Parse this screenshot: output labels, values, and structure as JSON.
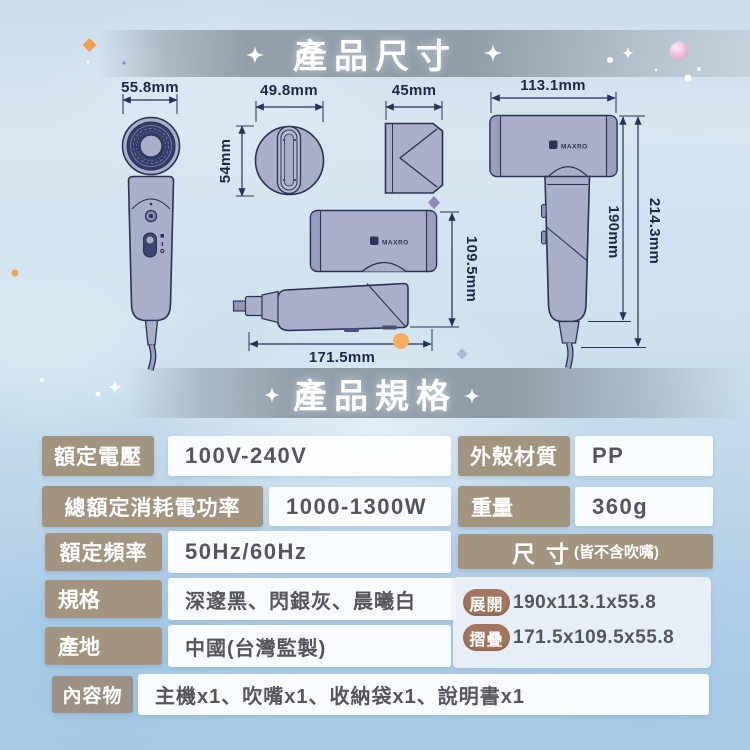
{
  "sections": {
    "dimensions_title": "產品尺寸",
    "specs_title": "產品規格"
  },
  "brand": {
    "logo": "MAXRO"
  },
  "dimensions": {
    "front_width": "55.8mm",
    "top_width": "49.8mm",
    "top_depth": "54mm",
    "nozzle_width": "45mm",
    "side_length": "113.1mm",
    "folded_height": "109.5mm",
    "folded_length": "171.5mm",
    "handle_height": "190mm",
    "total_height": "214.3mm"
  },
  "specs": {
    "left": [
      {
        "label": "額定電壓",
        "value": "100V-240V"
      },
      {
        "label": "總額定消耗電功率",
        "value": "1000-1300W"
      },
      {
        "label": "額定頻率",
        "value": "50Hz/60Hz"
      },
      {
        "label": "規格",
        "value": "深邃黑、閃銀灰、晨曦白"
      },
      {
        "label": "產地",
        "value": "中國(台灣監製)"
      }
    ],
    "right": [
      {
        "label": "外殼材質",
        "value": "PP"
      },
      {
        "label": "重量",
        "value": "360g"
      }
    ],
    "size": {
      "label": "尺寸",
      "note": "(皆不含吹嘴)",
      "rows": [
        {
          "tag": "展開",
          "value": "190x113.1x55.8"
        },
        {
          "tag": "摺疊",
          "value": "171.5x109.5x55.8"
        }
      ]
    },
    "contents": {
      "label": "內容物",
      "value": "主機x1、吹嘴x1、收納袋x1、說明書x1"
    }
  },
  "colors": {
    "label_tan": "#a39480",
    "pill_brown": "#a3765f",
    "title_band_gray": "#8c99a5",
    "dimension_ink": "#273155",
    "product_body": "#a9aec9",
    "value_ink": "#55565a",
    "accent_orange": "#f0a452",
    "pearl_pink": "#eec2da",
    "background_blue": "#c3daea"
  }
}
